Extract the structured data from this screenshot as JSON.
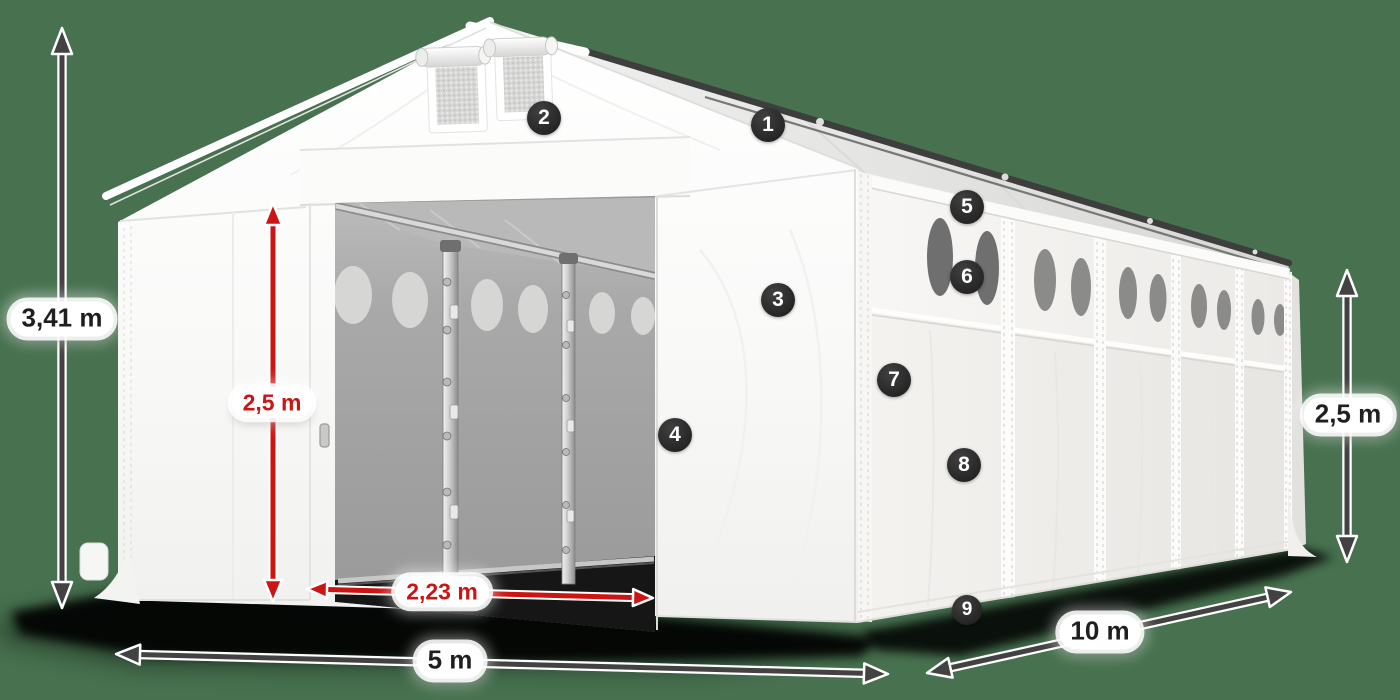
{
  "title": "Storage tent dimension diagram",
  "background_color": "#47714F",
  "labels": {
    "total_height": "3,41 m",
    "door_height": "2,5 m",
    "door_width": "2,23 m",
    "front_width": "5 m",
    "side_length": "10 m",
    "side_height": "2,5 m"
  },
  "markers": [
    "1",
    "2",
    "3",
    "4",
    "5",
    "6",
    "7",
    "8",
    "9"
  ],
  "colors": {
    "background": "#47714F",
    "dimension_dark": "#424242",
    "dimension_red": "#ce1313",
    "label_text_dark": "#1f1f1f",
    "label_text_red": "#cc1414",
    "marker_bg": "#2b2b2b",
    "marker_text": "#ffffff",
    "tent_white": "#fafafa",
    "interior_gray": "#a2a2a2"
  }
}
